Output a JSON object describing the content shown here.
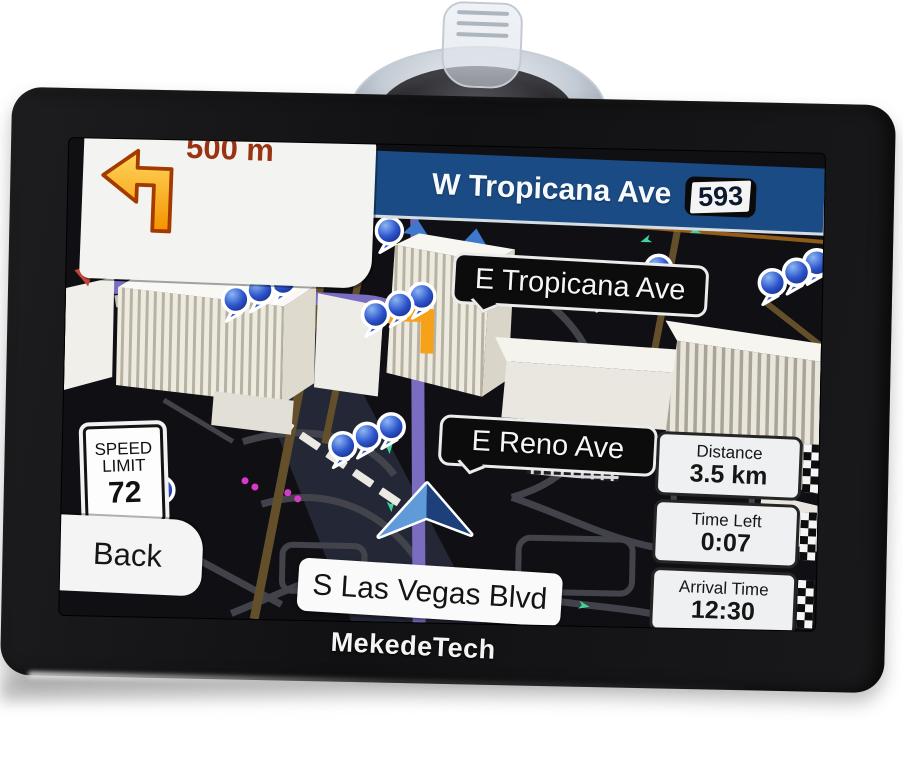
{
  "brand": {
    "logo_text": "MekedeTech"
  },
  "guidance": {
    "maneuver_icon": "turn-left-arrow-icon",
    "maneuver_distance": "500 m",
    "next_road": "W Tropicana Ave",
    "road_number": "593"
  },
  "map": {
    "street_labels": {
      "e_tropicana": "E Tropicana Ave",
      "e_reno": "E Reno Ave",
      "s_las_vegas": "S Las Vegas Blvd"
    },
    "speed_limit": {
      "line1": "SPEED",
      "line2": "LIMIT",
      "value": "72"
    }
  },
  "controls": {
    "back_label": "Back"
  },
  "trip_info": {
    "items": [
      {
        "label": "Distance",
        "value": "3.5 km"
      },
      {
        "label": "Time Left",
        "value": "0:07"
      },
      {
        "label": "Arrival Time",
        "value": "12:30"
      }
    ]
  },
  "colors": {
    "top_bar_blue": "#1b4b84",
    "route_purple": "#7a6cc0",
    "maneuver_orange": "#f59e00",
    "distance_text_red": "#993312",
    "pin_blue": "#2d55cc",
    "map_background": "#100f13"
  }
}
